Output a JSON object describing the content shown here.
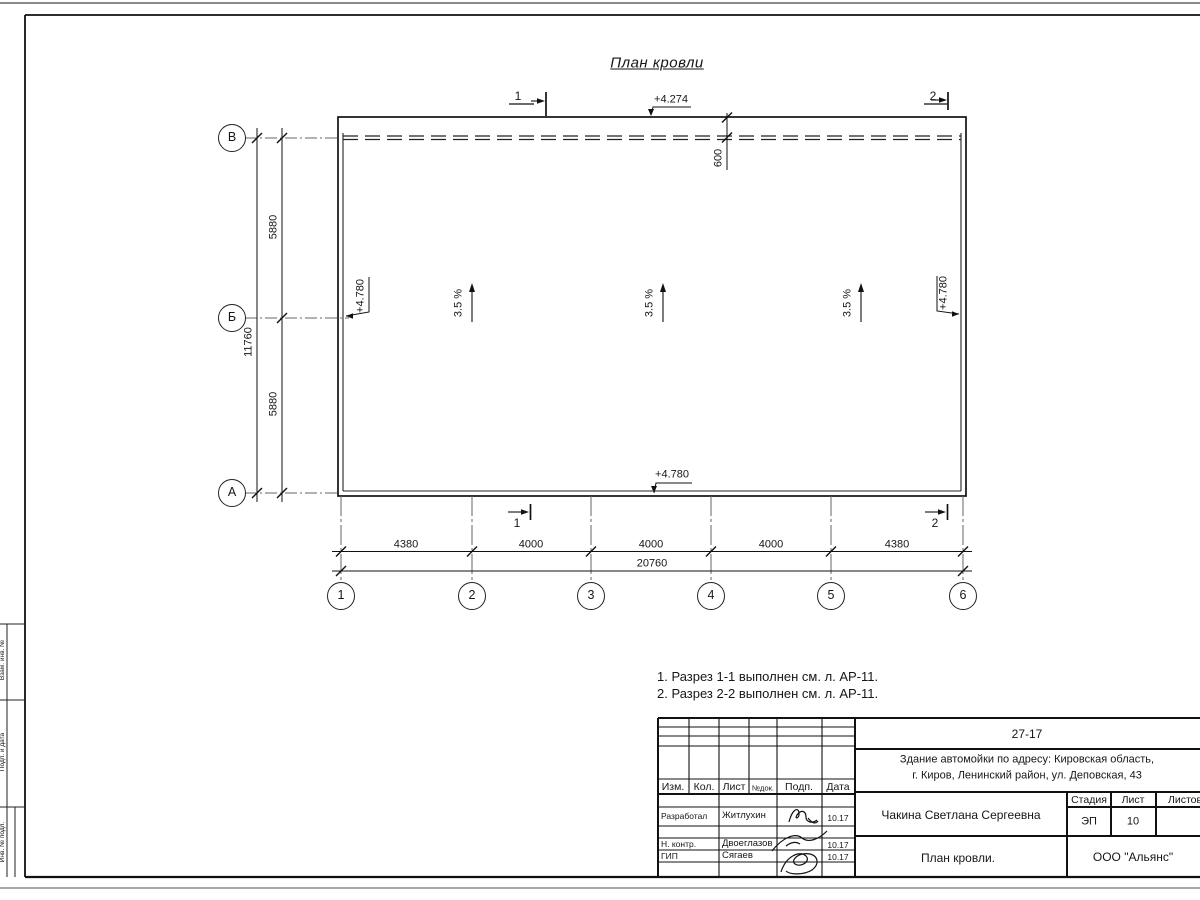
{
  "sheet": {
    "title": "План кровли",
    "notes": [
      "1. Разрез 1-1 выполнен см. л. АР-11.",
      "2. Разрез 2-2 выполнен см. л. АР-11."
    ]
  },
  "plan": {
    "slope_label": "3.5 %",
    "overhang_dim": "600",
    "elevation_top": "+4.274",
    "elevation_bottom": "+4.780",
    "elevation_left": "+4.780",
    "elevation_right": "+4.780"
  },
  "axes": {
    "rows": [
      "В",
      "Б",
      "А"
    ],
    "cols": [
      "1",
      "2",
      "3",
      "4",
      "5",
      "6"
    ]
  },
  "sections": {
    "one": "1",
    "two": "2"
  },
  "dims": {
    "h_segments": [
      "4380",
      "4000",
      "4000",
      "4000",
      "4380"
    ],
    "h_total": "20760",
    "v_segments": [
      "5880",
      "5880"
    ],
    "v_total": "11760"
  },
  "title_block": {
    "doc_number": "27-17",
    "project_line1": "Здание автомойки по адресу: Кировская область,",
    "project_line2": "г. Киров, Ленинский район, ул. Деповская, 43",
    "rev_headers": [
      "Изм.",
      "Кол.",
      "Лист",
      "№док.",
      "Подп.",
      "Дата"
    ],
    "roles": [
      {
        "role": "Разработал",
        "name": "Житлухин",
        "date": "10.17"
      },
      {
        "role": "Н. контр.",
        "name": "Двоеглазов",
        "date": "10.17"
      },
      {
        "role": "ГИП",
        "name": "Сягаев",
        "date": "10.17"
      }
    ],
    "author": "Чакина Светлана Сергеевна",
    "stage_header": "Стадия",
    "sheet_header": "Лист",
    "sheets_header": "Листов",
    "stage": "ЭП",
    "sheet_number": "10",
    "drawing_name": "План кровли.",
    "company": "ООО \"Альянс\""
  },
  "margin_stamps": [
    "Взам. инв. №",
    "Подп. и дата",
    "Инв. № подл."
  ]
}
